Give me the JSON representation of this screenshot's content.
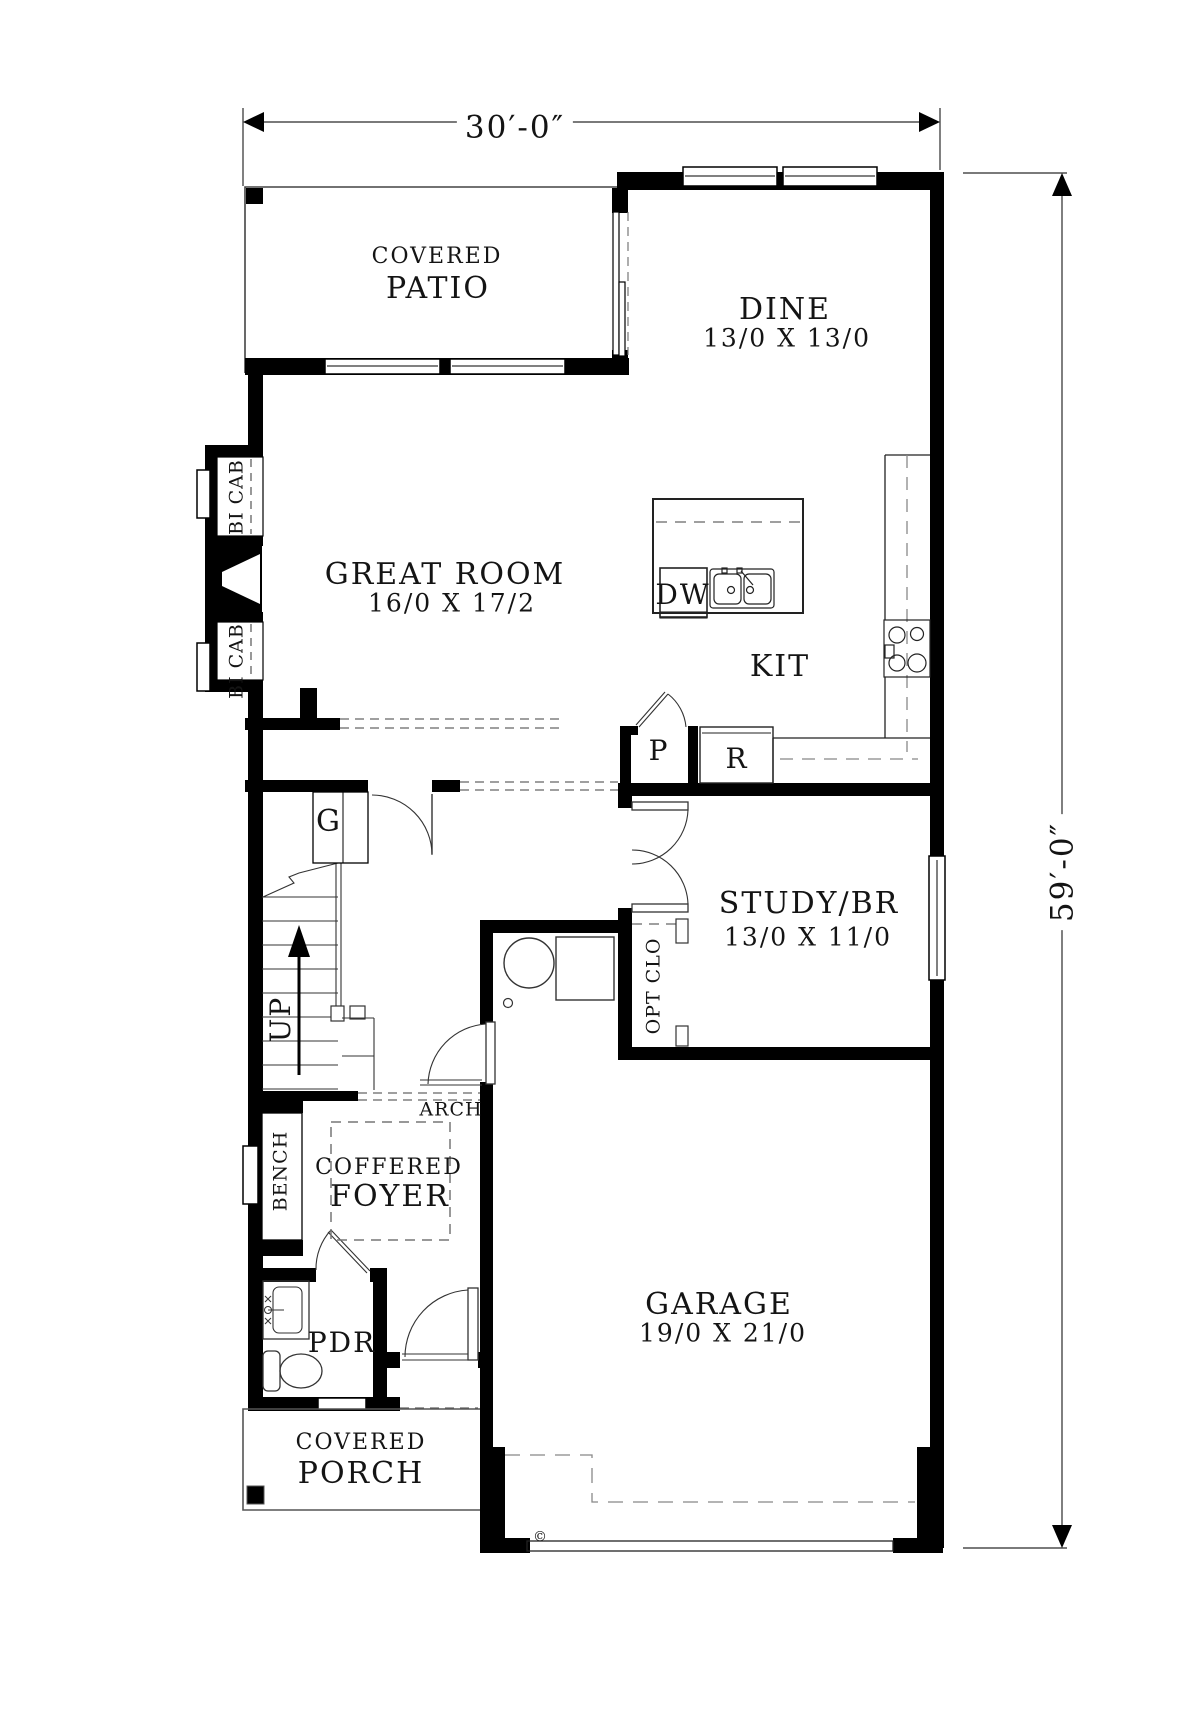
{
  "dimensions": {
    "overall_width": "30′-0″",
    "overall_height": "59′-0″"
  },
  "rooms": {
    "patio": {
      "line1": "COVERED",
      "line2": "PATIO"
    },
    "dine": {
      "name": "DINE",
      "size": "13/0 X 13/0"
    },
    "great_room": {
      "name": "GREAT ROOM",
      "size": "16/0 X 17/2"
    },
    "kitchen": {
      "name": "KIT"
    },
    "study": {
      "name": "STUDY/BR",
      "size": "13/0 X 11/0"
    },
    "foyer": {
      "line1": "COFFERED",
      "line2": "FOYER"
    },
    "powder": {
      "name": "PDR"
    },
    "garage": {
      "name": "GARAGE",
      "size": "19/0 X 21/0"
    },
    "porch": {
      "line1": "COVERED",
      "line2": "PORCH"
    }
  },
  "annotations": {
    "bi_cab": "BI CAB",
    "dishwasher": "DW",
    "pantry": "P",
    "refrigerator": "R",
    "g_closet": "G",
    "stairs_up": "UP",
    "arch": "ARCH",
    "bench": "BENCH",
    "optional_closet": "OPT CLO",
    "copyright": "©"
  },
  "colors": {
    "wall": "#000000",
    "line": "#2b2b2b",
    "dash_gray": "#8a8a8a",
    "text": "#141414",
    "background": "#ffffff"
  }
}
